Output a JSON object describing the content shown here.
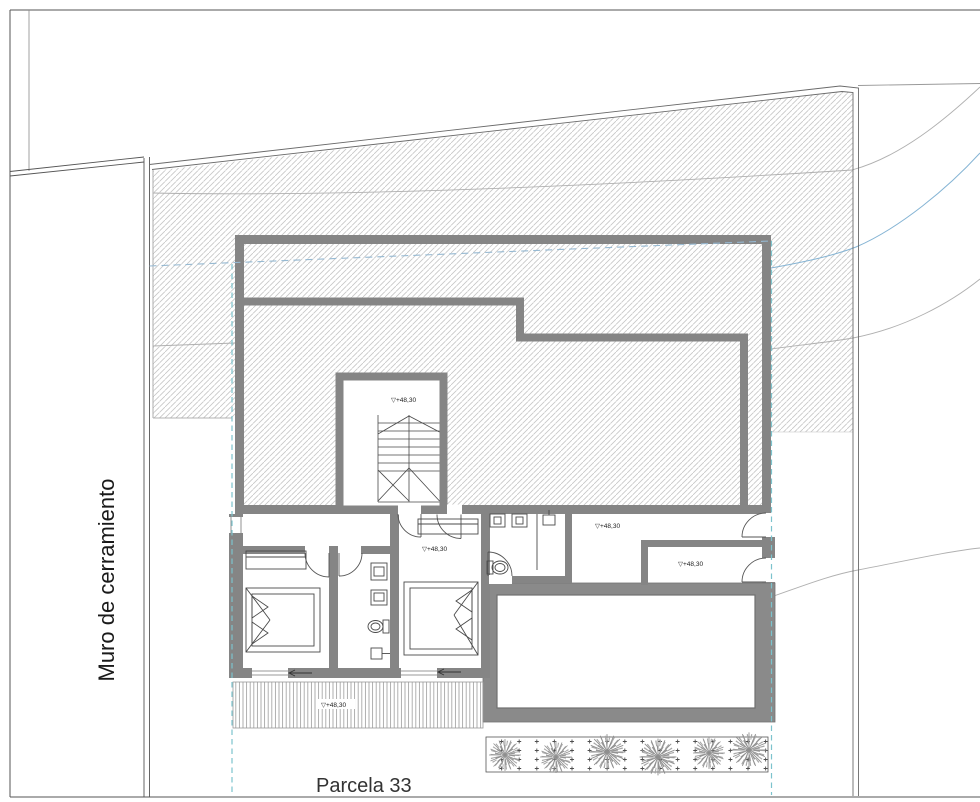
{
  "drawing": {
    "labels": {
      "parcel": "Parcela 33",
      "perimeter_wall": "Muro de cerramiento"
    },
    "elevation_marks": {
      "stairwell": "▽+48,30",
      "master_bedroom": "▽+48,30",
      "hall": "▽+48,30",
      "guest_room": "▽+48,30",
      "deck": "▽+48,30"
    },
    "colors": {
      "wall_gray": "#858585",
      "terrace_gray": "#8a8a8a",
      "hatch_line": "#c6c6c6",
      "envelope_dashed_teal": "#7cc3cd",
      "envelope_dashed_blue": "#96b9d2",
      "stream_blue": "#85b4d4",
      "contour_gray": "#b0b0b0",
      "line_dark": "#4a4a4a"
    }
  }
}
